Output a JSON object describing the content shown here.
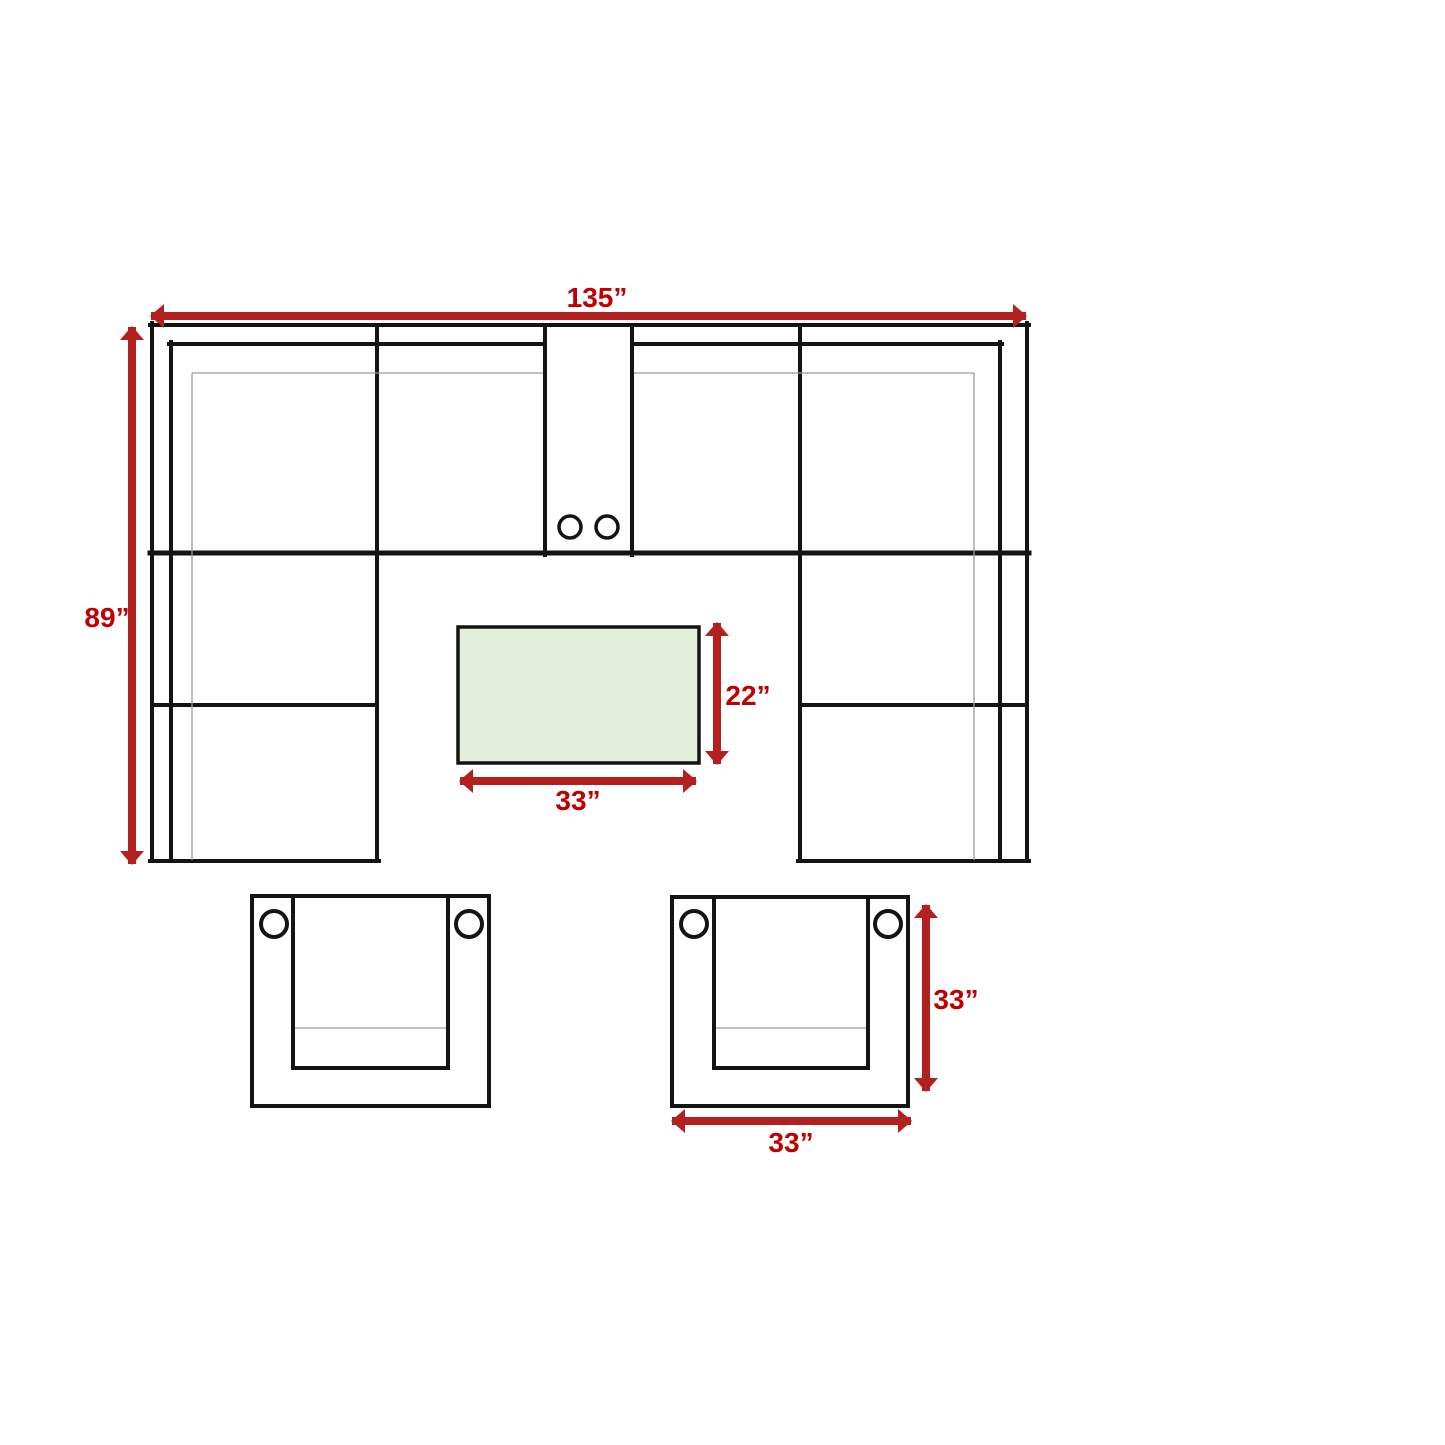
{
  "diagram_type": "sectional-sofa-dimension-plan",
  "sofa": {
    "width_label": "135”",
    "depth_label": "89”"
  },
  "coffee_table": {
    "width_label": "33”",
    "depth_label": "22”"
  },
  "accent_chair": {
    "width_label": "33”",
    "depth_label": "33”"
  },
  "colors": {
    "background": "#ffffff",
    "outline": "#141414",
    "thin_line": "#9b9b9b",
    "arrow": "#b32020",
    "dimension_text": "#c00000",
    "table_fill": "#e3eeda"
  }
}
